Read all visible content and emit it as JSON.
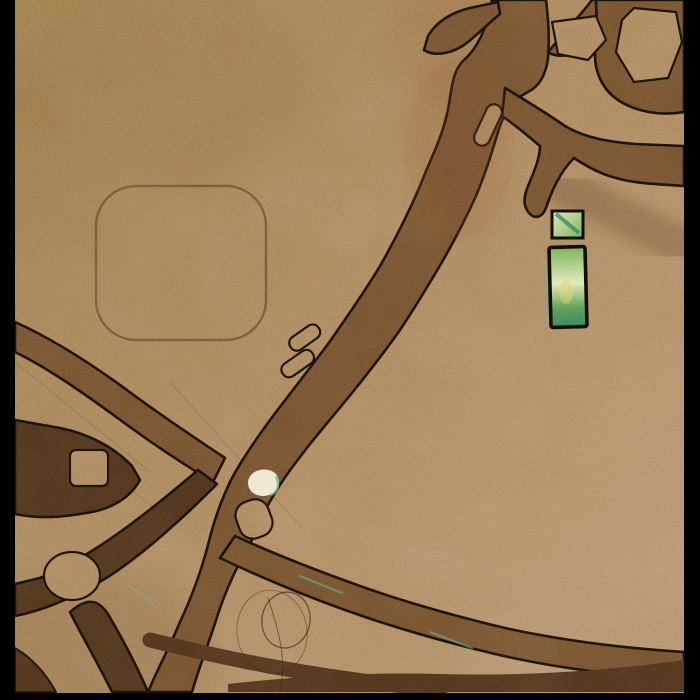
{
  "window": {
    "width": 700,
    "height": 700
  },
  "artwork": {
    "kind": "abstract sand-textured mixed-media painting with incised dark branching channels",
    "palette": {
      "frame": "#000000",
      "sand_light": "#b2906a",
      "sand_base": "#a8825a",
      "sand_dark": "#997649",
      "channel": "#6f4e2c",
      "channel_dark": "#4c321b",
      "outline": "#171008",
      "rust": "#8a5230",
      "inlay_green_light": "#dfe6b0",
      "inlay_green": "#6aaa4d",
      "inlay_green_deep": "#57984d",
      "inlay_teal": "#2e7d5c",
      "spot_white": "#ece6ce",
      "teal_fringe": "#5ea57f",
      "scribble": "#2a2112",
      "scratch": "#3a2c18"
    },
    "elements": {
      "letterbox": "black bars along left, right and bottom edges",
      "main_channel": "wide dark channel running diagonally from top center to bottom left",
      "top_branches": "branching channels toward the top and right edges with a hexagonal sand island",
      "right_fork": "forked channel reaching the right edge with a tapering claw above the green inlay",
      "left_network": "crossing channels meeting the left edge with square and oval sand islands",
      "bottom_network": "channels fanning toward the bottom and right edges",
      "rounded_square": "faint incised rounded-square outline in the upper left quadrant",
      "green_inlay": "small glazed green square above a tall green rectangle, right of center",
      "white_spot": "small cream-white chip embedded in the channel near center left",
      "scribbles": "thin looping pen scribbles near the bottom center",
      "slot_islands": "narrow sand slots left inside the main channel"
    }
  }
}
